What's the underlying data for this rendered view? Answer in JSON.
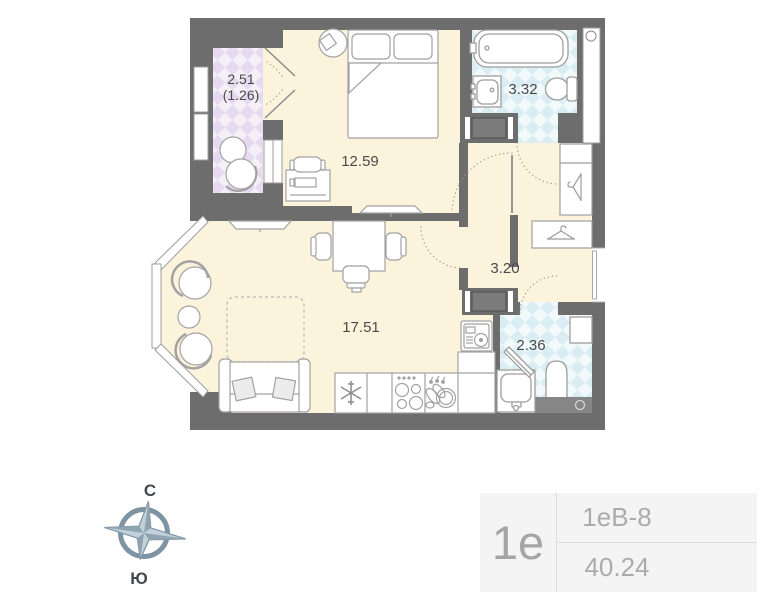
{
  "plan": {
    "labels": {
      "balcony_area": "2.51",
      "balcony_reduced": "(1.26)",
      "bedroom_area": "12.59",
      "bathroom_area": "3.32",
      "hallway_area": "3.20",
      "living_area": "17.51",
      "wc_area": "2.36"
    },
    "colors": {
      "wall": "#6d6d6d",
      "floor_cream": "#fcf3dd",
      "tile_purple": "#e5daef",
      "tile_blue": "#d9edf3",
      "furniture_outline": "#a2a2a2"
    },
    "icons": {
      "fridge": "snowflake-icon",
      "stove": "burners-icon",
      "kitchen_sink": "dishes-icon",
      "washer": "washing-machine-icon",
      "wardrobes": "clothes-hanger-icon",
      "bathroom": "bathtub-sink-toilet-icons",
      "vents": "ventilation-circle-icon"
    }
  },
  "compass": {
    "north_label": "С",
    "south_label": "Ю"
  },
  "info_card": {
    "unit_short": "1е",
    "unit_code": "1еВ-8",
    "total_area": "40.24"
  }
}
